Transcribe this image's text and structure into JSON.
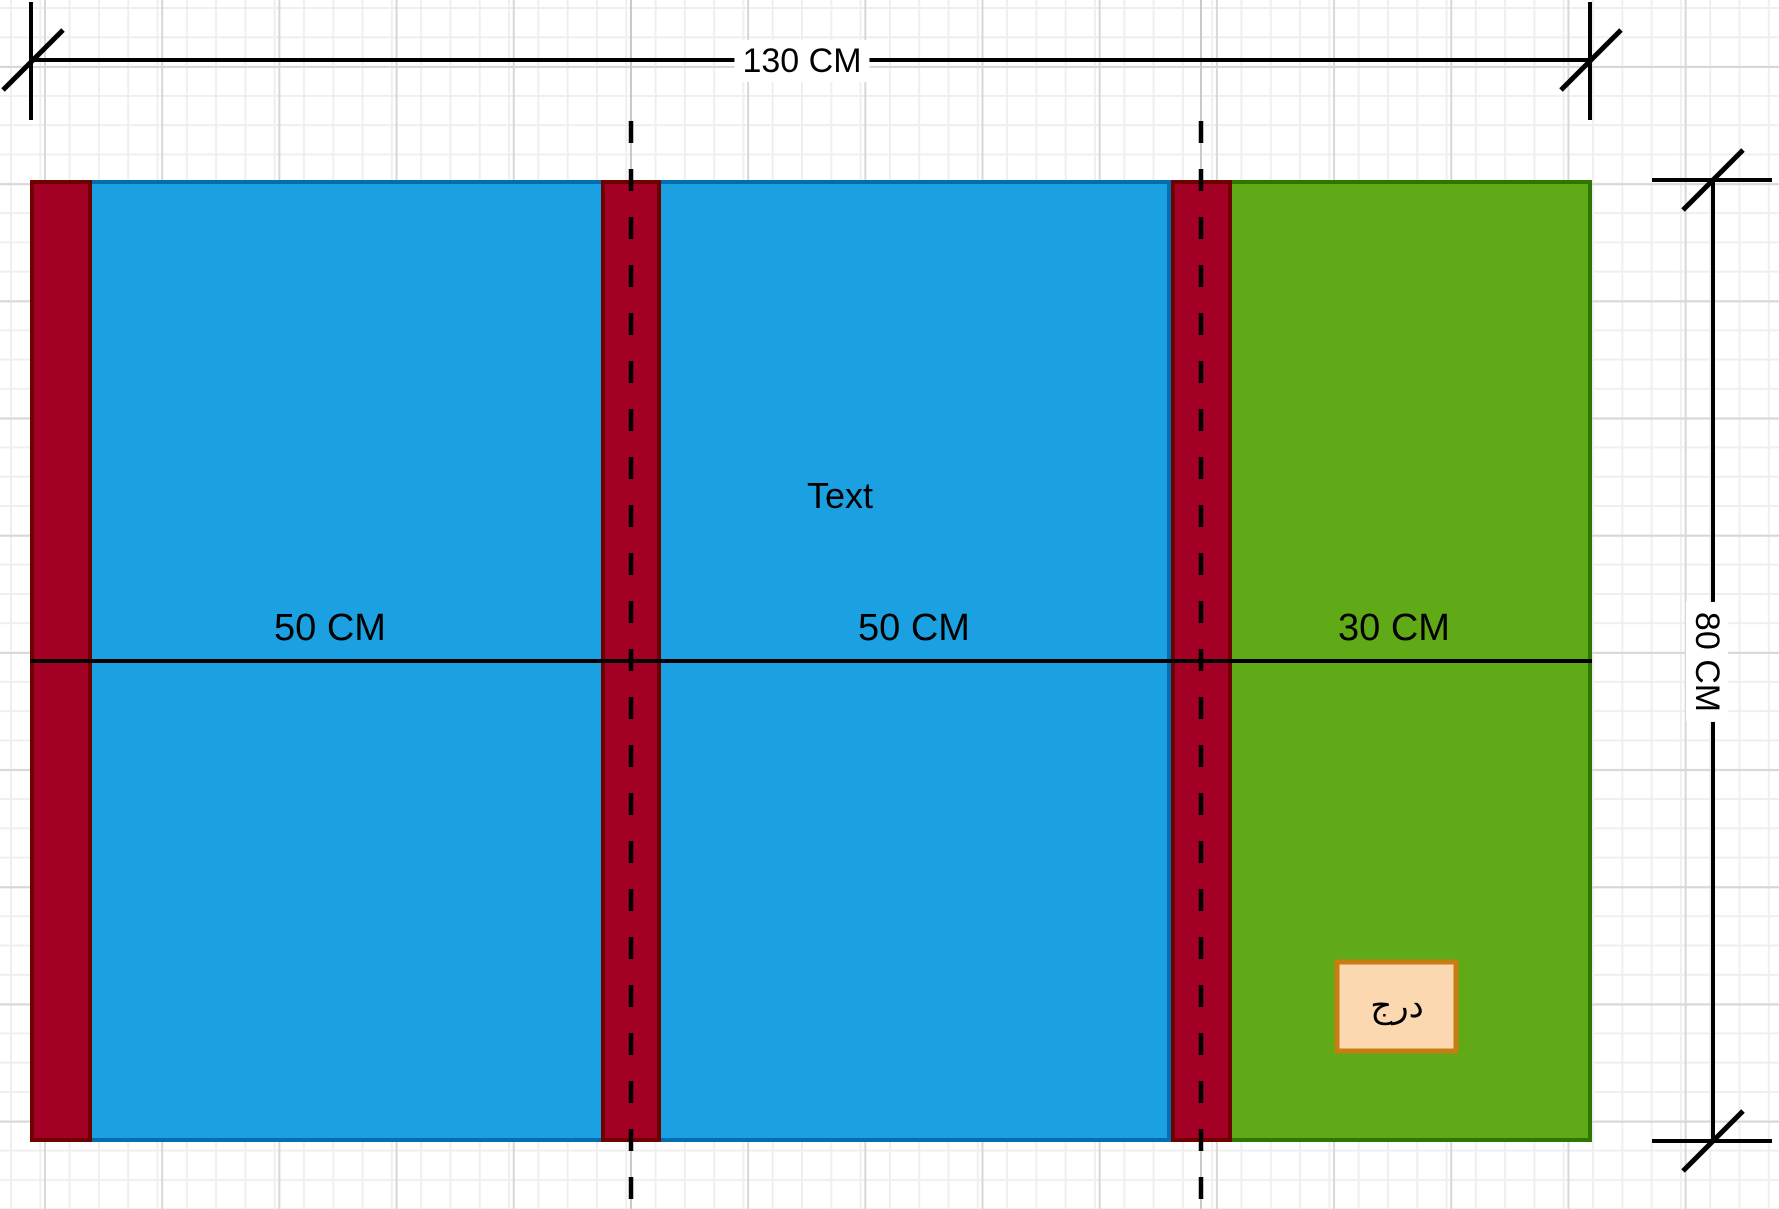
{
  "diagram": {
    "dimension_width": {
      "label": "130 CM"
    },
    "dimension_height": {
      "label": "80 CM"
    },
    "sections": [
      {
        "label": "50 CM",
        "color": "blue"
      },
      {
        "label": "50 CM",
        "color": "blue"
      },
      {
        "label": "30 CM",
        "color": "green"
      }
    ],
    "free_text": {
      "label": "Text"
    },
    "drawer_box": {
      "label": "درج"
    }
  },
  "colors": {
    "blue_fill": "#1BA1E2",
    "blue_stroke": "#006EAF",
    "red_fill": "#A20025",
    "red_stroke": "#6F0000",
    "green_fill": "#60A917",
    "green_stroke": "#2D7600",
    "orange_fill": "#FBD8B0",
    "orange_stroke": "#C77D12",
    "line_color": "#000000",
    "guide_color": "#C9C9C9"
  }
}
